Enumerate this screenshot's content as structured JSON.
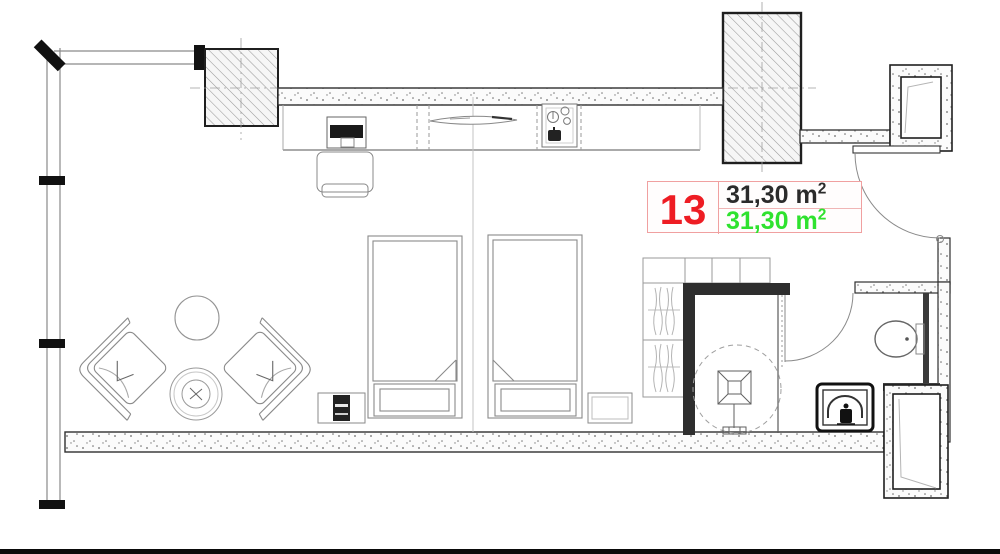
{
  "page": {
    "background": "#ffffff",
    "type": "architectural floor plan"
  },
  "unit_label": {
    "number": "13",
    "gross_area": "31,30 m",
    "gross_sup": "2",
    "net_area": "31,30 m",
    "net_sup": "2"
  },
  "colors": {
    "unit_number_red": "#ee1c23",
    "gross_area_black": "#2b2b2b",
    "net_area_green": "#2fe22f",
    "label_table_border": "#f0a0a0",
    "wall_line": "#2f2f2f",
    "bottom_edge_bar": "#0a0a0a"
  }
}
